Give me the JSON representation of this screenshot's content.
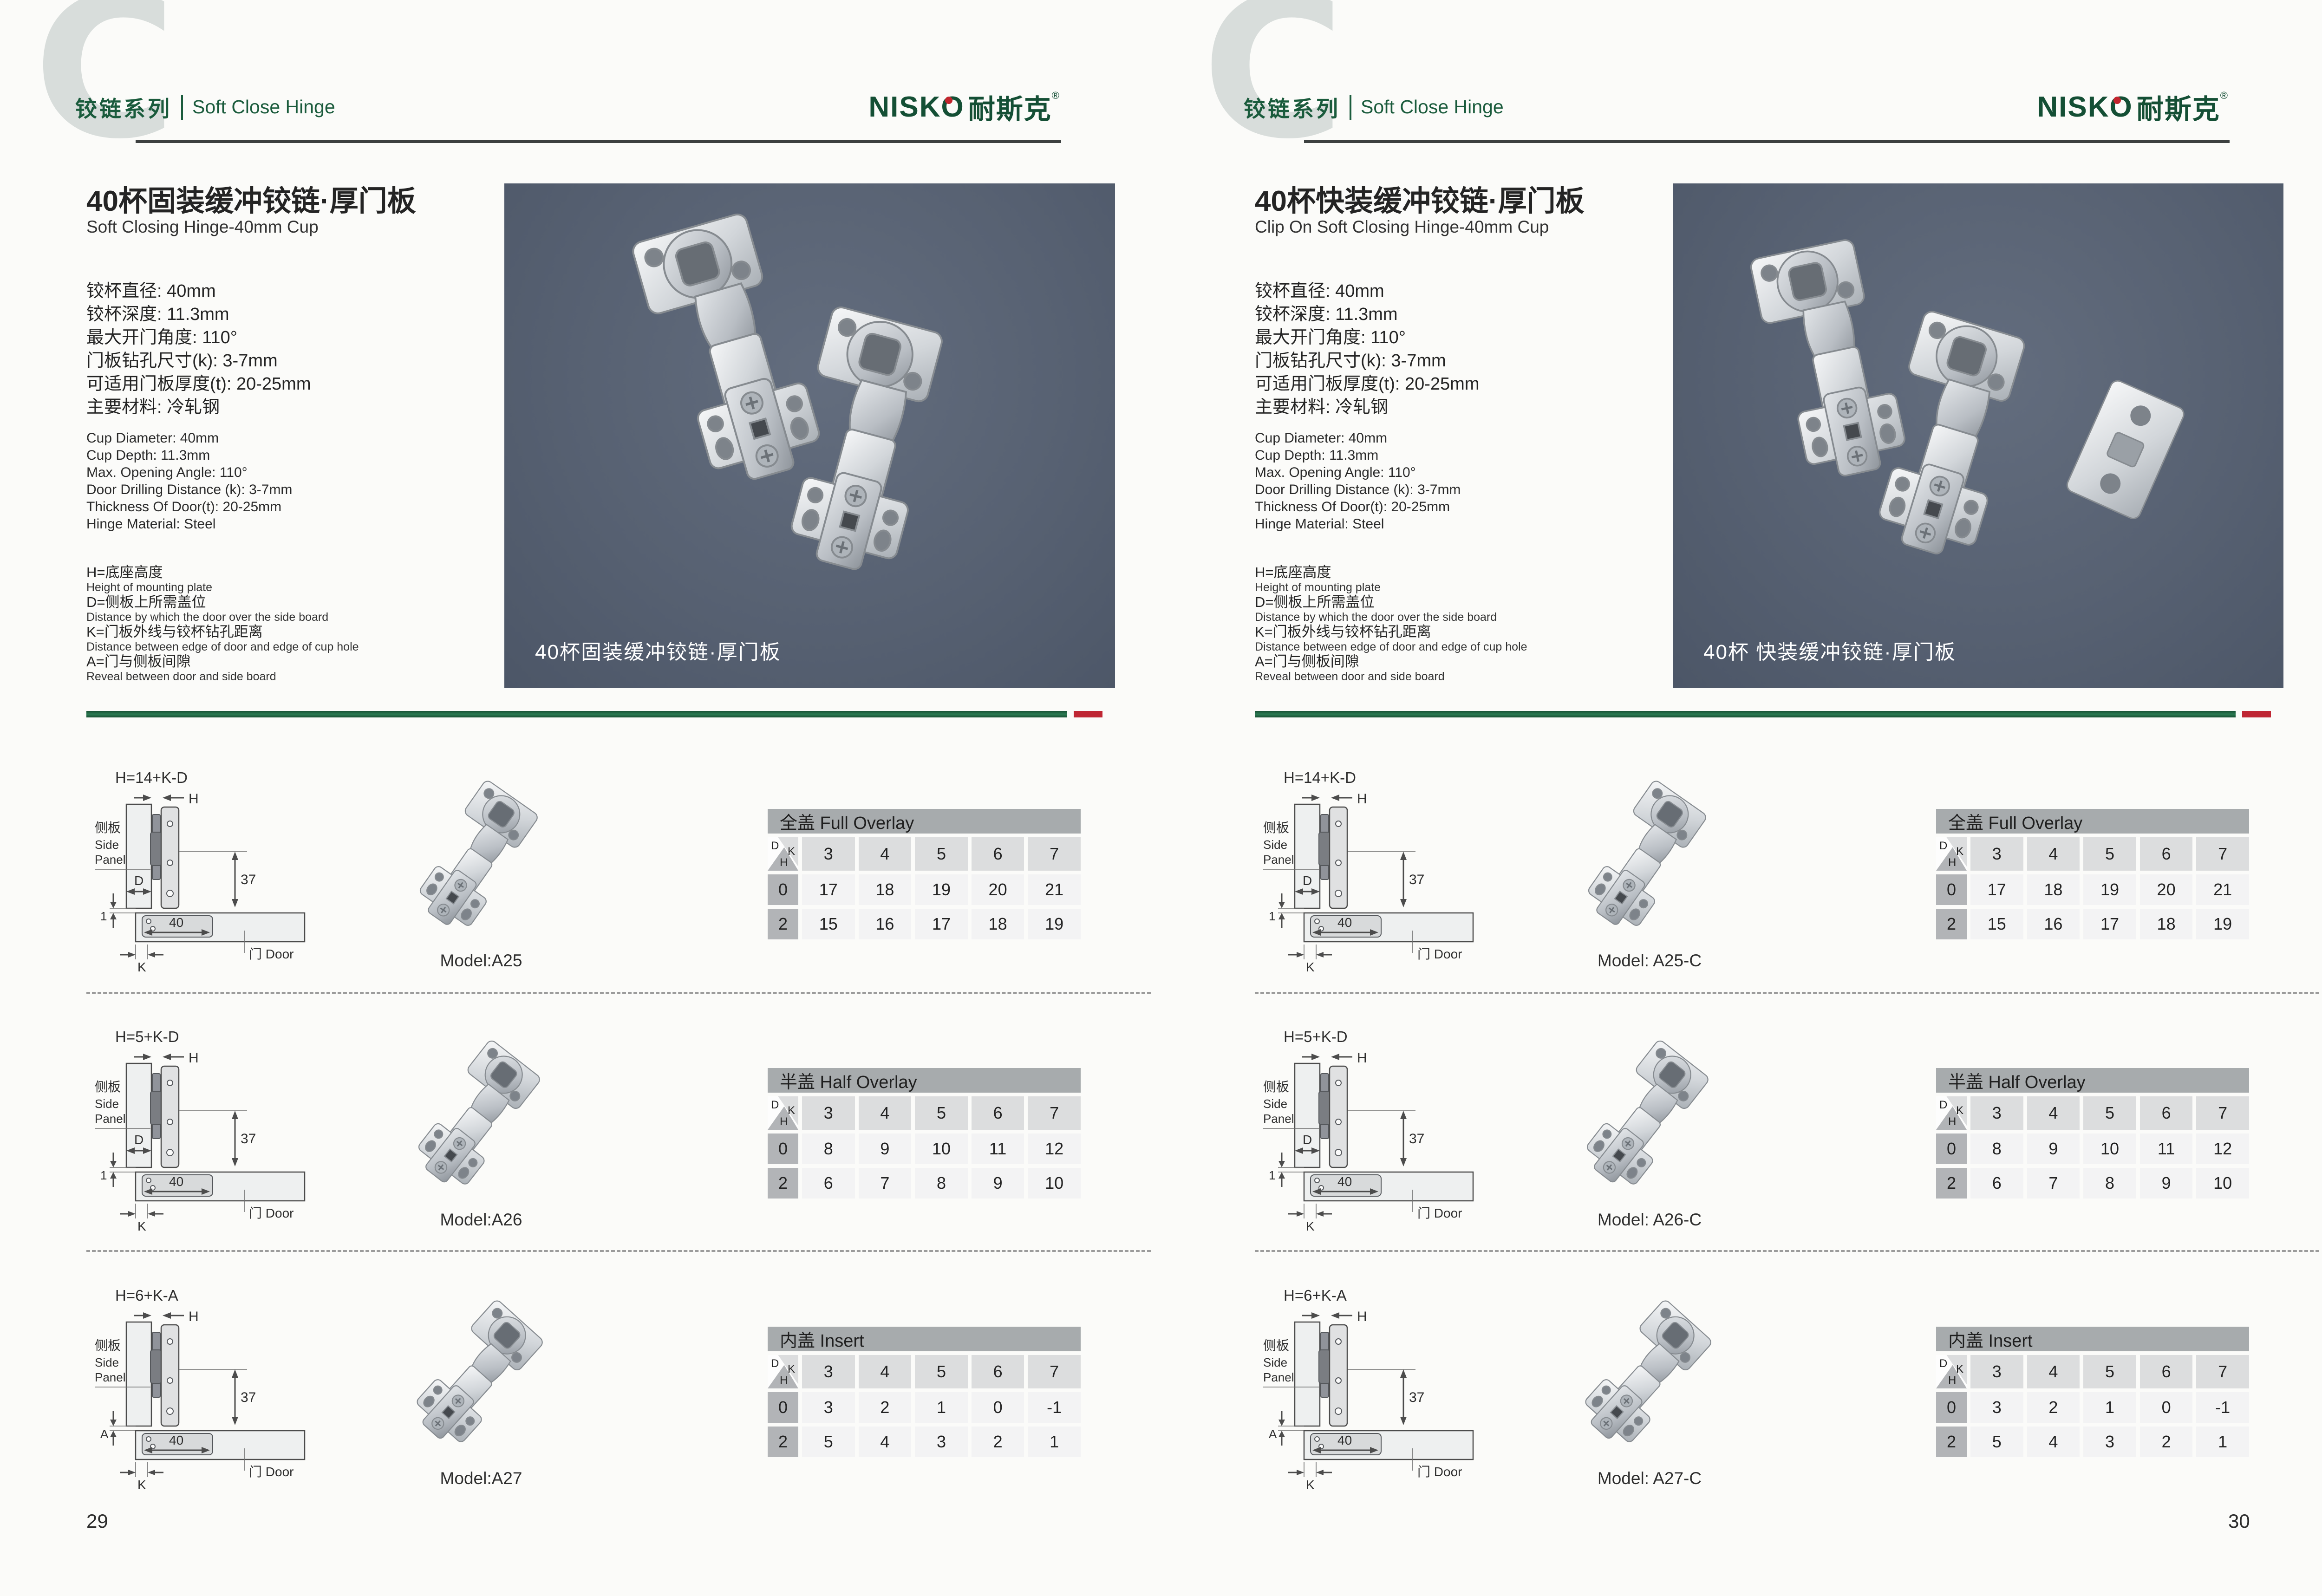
{
  "brand": {
    "series_letter": "C",
    "series_cn": "铰链系列",
    "series_en": "Soft Close Hinge",
    "logo_latin": "NISKO",
    "logo_cn": "耐斯克",
    "logo_reg": "®"
  },
  "colors": {
    "brand_green": "#1a5b3c",
    "accent_red": "#bf2633",
    "header_rule": "#3c4040",
    "photo_background": "#576172",
    "table_header_gray": "#a7abad"
  },
  "pages": [
    {
      "page_number": "29",
      "title_cn": "40杯固装缓冲铰链·厚门板",
      "title_en": "Soft Closing Hinge-40mm Cup",
      "specs_cn": [
        "铰杯直径: 40mm",
        "铰杯深度: 11.3mm",
        "最大开门角度: 110°",
        "门板钻孔尺寸(k): 3-7mm",
        "可适用门板厚度(t): 20-25mm",
        "主要材料: 冷轧钢"
      ],
      "specs_en": [
        "Cup Diameter: 40mm",
        "Cup Depth: 11.3mm",
        "Max. Opening Angle: 110°",
        "Door Drilling Distance (k): 3-7mm",
        "Thickness Of Door(t): 20-25mm",
        "Hinge Material: Steel"
      ],
      "legend": [
        {
          "cn": "H=底座高度",
          "en": "Height of mounting plate"
        },
        {
          "cn": "D=侧板上所需盖位",
          "en": "Distance by which the door over the side board"
        },
        {
          "cn": "K=门板外线与铰杯钻孔距离",
          "en": "Distance between edge of door and edge of cup hole"
        },
        {
          "cn": "A=门与侧板间隙",
          "en": "Reveal between door and side board"
        }
      ],
      "photo_caption": "40杯固装缓冲铰链·厚门板",
      "diagram": {
        "h_label": "H",
        "depth_label": "37",
        "cup_label": "40",
        "k_label": "K",
        "door_label": "门 Door",
        "panel_cn": "侧板",
        "panel_en_1": "Side",
        "panel_en_2": "Panel"
      },
      "rows": [
        {
          "formula": "H=14+K-D",
          "dim_label": "D",
          "gap_label": "1",
          "model": "Model:A25",
          "table": {
            "title": "全盖 Full Overlay",
            "corner": {
              "d": "D",
              "k": "K",
              "h": "H"
            },
            "k_values": [
              "3",
              "4",
              "5",
              "6",
              "7"
            ],
            "data_rows": [
              {
                "h": "0",
                "values": [
                  "17",
                  "18",
                  "19",
                  "20",
                  "21"
                ]
              },
              {
                "h": "2",
                "values": [
                  "15",
                  "16",
                  "17",
                  "18",
                  "19"
                ]
              }
            ]
          }
        },
        {
          "formula": "H=5+K-D",
          "dim_label": "D",
          "gap_label": "1",
          "model": "Model:A26",
          "table": {
            "title": "半盖 Half Overlay",
            "corner": {
              "d": "D",
              "k": "K",
              "h": "H"
            },
            "k_values": [
              "3",
              "4",
              "5",
              "6",
              "7"
            ],
            "data_rows": [
              {
                "h": "0",
                "values": [
                  "8",
                  "9",
                  "10",
                  "11",
                  "12"
                ]
              },
              {
                "h": "2",
                "values": [
                  "6",
                  "7",
                  "8",
                  "9",
                  "10"
                ]
              }
            ]
          }
        },
        {
          "formula": "H=6+K-A",
          "dim_label": "",
          "gap_label": "A",
          "model": "Model:A27",
          "table": {
            "title": "内盖 Insert",
            "corner": {
              "d": "D",
              "k": "K",
              "h": "H"
            },
            "k_values": [
              "3",
              "4",
              "5",
              "6",
              "7"
            ],
            "data_rows": [
              {
                "h": "0",
                "values": [
                  "3",
                  "2",
                  "1",
                  "0",
                  "-1"
                ]
              },
              {
                "h": "2",
                "values": [
                  "5",
                  "4",
                  "3",
                  "2",
                  "1"
                ]
              }
            ]
          }
        }
      ]
    },
    {
      "page_number": "30",
      "title_cn": "40杯快装缓冲铰链·厚门板",
      "title_en": "Clip On Soft Closing Hinge-40mm Cup",
      "specs_cn": [
        "铰杯直径: 40mm",
        "铰杯深度: 11.3mm",
        "最大开门角度: 110°",
        "门板钻孔尺寸(k): 3-7mm",
        "可适用门板厚度(t): 20-25mm",
        "主要材料: 冷轧钢"
      ],
      "specs_en": [
        "Cup Diameter: 40mm",
        "Cup Depth: 11.3mm",
        "Max. Opening Angle: 110°",
        "Door Drilling Distance (k): 3-7mm",
        "Thickness Of Door(t): 20-25mm",
        "Hinge Material: Steel"
      ],
      "legend": [
        {
          "cn": "H=底座高度",
          "en": "Height of mounting plate"
        },
        {
          "cn": "D=侧板上所需盖位",
          "en": "Distance by which the door over the side board"
        },
        {
          "cn": "K=门板外线与铰杯钻孔距离",
          "en": "Distance between edge of door and edge of cup hole"
        },
        {
          "cn": "A=门与侧板间隙",
          "en": "Reveal between door and side board"
        }
      ],
      "photo_caption": "40杯 快装缓冲铰链·厚门板",
      "diagram": {
        "h_label": "H",
        "depth_label": "37",
        "cup_label": "40",
        "k_label": "K",
        "door_label": "门 Door",
        "panel_cn": "侧板",
        "panel_en_1": "Side",
        "panel_en_2": "Panel"
      },
      "rows": [
        {
          "formula": "H=14+K-D",
          "dim_label": "D",
          "gap_label": "1",
          "model": "Model: A25-C",
          "table": {
            "title": "全盖 Full Overlay",
            "corner": {
              "d": "D",
              "k": "K",
              "h": "H"
            },
            "k_values": [
              "3",
              "4",
              "5",
              "6",
              "7"
            ],
            "data_rows": [
              {
                "h": "0",
                "values": [
                  "17",
                  "18",
                  "19",
                  "20",
                  "21"
                ]
              },
              {
                "h": "2",
                "values": [
                  "15",
                  "16",
                  "17",
                  "18",
                  "19"
                ]
              }
            ]
          }
        },
        {
          "formula": "H=5+K-D",
          "dim_label": "D",
          "gap_label": "1",
          "model": "Model: A26-C",
          "table": {
            "title": "半盖 Half Overlay",
            "corner": {
              "d": "D",
              "k": "K",
              "h": "H"
            },
            "k_values": [
              "3",
              "4",
              "5",
              "6",
              "7"
            ],
            "data_rows": [
              {
                "h": "0",
                "values": [
                  "8",
                  "9",
                  "10",
                  "11",
                  "12"
                ]
              },
              {
                "h": "2",
                "values": [
                  "6",
                  "7",
                  "8",
                  "9",
                  "10"
                ]
              }
            ]
          }
        },
        {
          "formula": "H=6+K-A",
          "dim_label": "",
          "gap_label": "A",
          "model": "Model: A27-C",
          "table": {
            "title": "内盖 Insert",
            "corner": {
              "d": "D",
              "k": "K",
              "h": "H"
            },
            "k_values": [
              "3",
              "4",
              "5",
              "6",
              "7"
            ],
            "data_rows": [
              {
                "h": "0",
                "values": [
                  "3",
                  "2",
                  "1",
                  "0",
                  "-1"
                ]
              },
              {
                "h": "2",
                "values": [
                  "5",
                  "4",
                  "3",
                  "2",
                  "1"
                ]
              }
            ]
          }
        }
      ]
    }
  ]
}
